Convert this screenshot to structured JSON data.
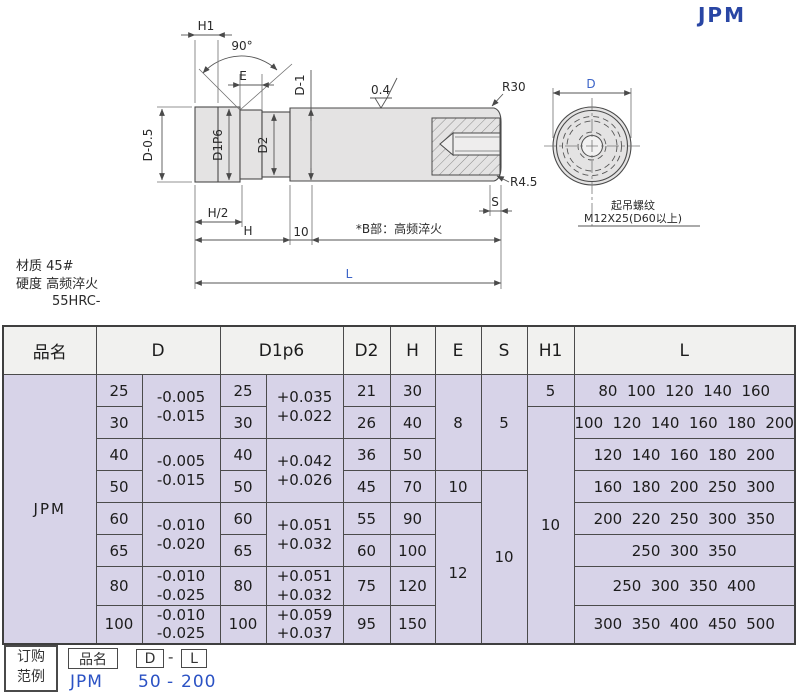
{
  "title": "JPM",
  "colors": {
    "accent_blue": "#2946a4",
    "example_blue": "#2b52c4",
    "drawing_blue": "#3c64c8",
    "cell_bg": "#d7d3e8",
    "header_bg": "#f1f1ef"
  },
  "drawing": {
    "labels": {
      "h1": "H1",
      "angle": "90°",
      "e": "E",
      "d05": "D-0.5",
      "d1p6": "D1P6",
      "d2": "D2",
      "dminus1": "D-1",
      "roughness": "0.4",
      "r30": "R30",
      "r45": "R4.5",
      "s": "S",
      "h_half": "H/2",
      "h": "H",
      "ten": "10",
      "b_note": "*B部：高频淬火",
      "l": "L",
      "d": "D",
      "lift_line1": "起吊螺纹",
      "lift_line2": "M12X25(D60以上)"
    },
    "material": {
      "line1": "材质  45#",
      "line2": "硬度  高频淬火",
      "line3": "55HRC-"
    }
  },
  "table": {
    "headers": {
      "pinming": "品名",
      "d": "D",
      "d1p6": "D1p6",
      "d2": "D2",
      "h": "H",
      "e": "E",
      "s": "S",
      "h1": "H1",
      "l": "L"
    },
    "product": "JPM",
    "d": [
      "25",
      "30",
      "40",
      "50",
      "60",
      "65",
      "80",
      "100"
    ],
    "d_tol": [
      "-0.005\n-0.015",
      "-0.005\n-0.015",
      "-0.010\n-0.020",
      "-0.010\n-0.025",
      "-0.010\n-0.025"
    ],
    "d1": [
      "25",
      "30",
      "40",
      "50",
      "60",
      "65",
      "80",
      "100"
    ],
    "d1_tol": [
      "+0.035\n+0.022",
      "+0.042\n+0.026",
      "+0.051\n+0.032",
      "+0.051\n+0.032",
      "+0.059\n+0.037"
    ],
    "d2": [
      "21",
      "26",
      "36",
      "45",
      "55",
      "60",
      "75",
      "95"
    ],
    "h": [
      "30",
      "40",
      "50",
      "70",
      "90",
      "100",
      "120",
      "150"
    ],
    "e": [
      "8",
      "10",
      "12"
    ],
    "s": [
      "5",
      "10"
    ],
    "h1": [
      "5",
      "10"
    ],
    "l": [
      "80  100  120  140  160",
      "100  120  140  160  180  200",
      "120  140  160  180  200",
      "160  180  200  250  300",
      "200  220  250  300  350",
      "250  300  350",
      "250  300  350  400",
      "300  350  400  450  500"
    ]
  },
  "order_example": {
    "box_line1": "订购",
    "box_line2": "范例",
    "pinming": "品名",
    "d": "D",
    "dash": "-",
    "l": "L",
    "example_name": "JPM",
    "example_d": "50",
    "example_l": "200"
  }
}
